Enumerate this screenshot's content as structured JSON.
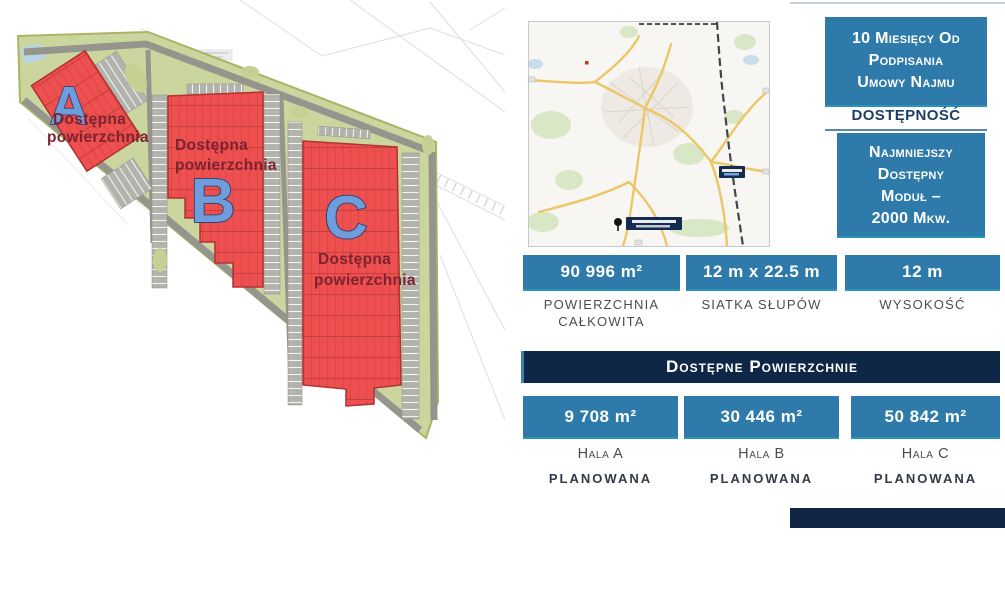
{
  "slide": {
    "colors": {
      "accent_blue": "#2e7bab",
      "navy": "#0e2747",
      "building_red": "#ee4f4f",
      "site_green": "#cbd69e",
      "letter_blue": "#6f9ddc",
      "note_red": "#7c2330",
      "label_gray": "#4c4c4c"
    },
    "site_plan": {
      "buildings": [
        {
          "letter": "A",
          "note": [
            "Dostępna",
            "powierzchnia"
          ]
        },
        {
          "letter": "B",
          "note": [
            "Dostępna",
            "powierzchnia"
          ]
        },
        {
          "letter": "C",
          "note": [
            "Dostępna",
            "powierzchnia"
          ]
        }
      ]
    },
    "availability": {
      "lead_time_lines": [
        "10 Miesięcy Od",
        "Podpisania",
        "Umowy Najmu"
      ],
      "caption": "DOSTĘPNOŚĆ",
      "min_module_lines": [
        "Najmniejszy",
        "Dostępny",
        "Moduł –",
        "2000 Mkw."
      ]
    },
    "stats": [
      {
        "value": "90 996 m²",
        "label": "POWIERZCHNIA CAŁKOWITA"
      },
      {
        "value": "12 m x 22.5 m",
        "label": "SIATKA SŁUPÓW"
      },
      {
        "value": "12 m",
        "label": "WYSOKOŚĆ"
      }
    ],
    "available_areas": {
      "title": "Dostępne Powierzchnie",
      "halls": [
        {
          "value": "9 708 m²",
          "name": "Hala A",
          "status": "PLANOWANA"
        },
        {
          "value": "30 446 m²",
          "name": "Hala B",
          "status": "PLANOWANA"
        },
        {
          "value": "50 842 m²",
          "name": "Hala C",
          "status": "PLANOWANA"
        }
      ]
    }
  }
}
